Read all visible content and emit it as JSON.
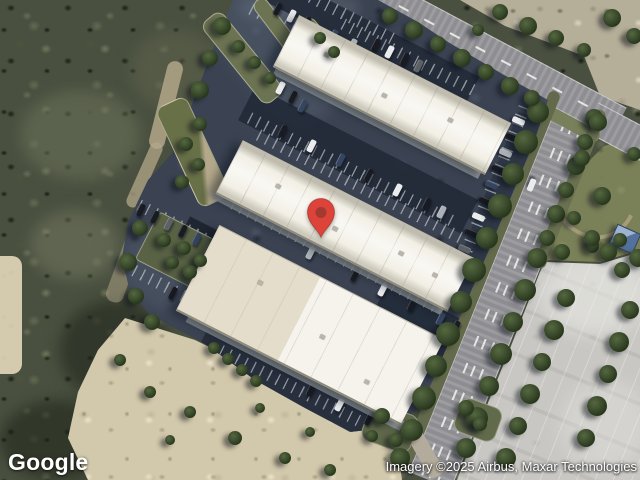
{
  "map": {
    "provider": "Google",
    "view_type": "satellite",
    "logo_text": "Google",
    "attribution_text": "Imagery ©2025 Airbus, Maxar Technologies",
    "marker": {
      "x": 321,
      "y": 239,
      "body_color": "#DD4339",
      "inner_dot_color": "#A23A30"
    }
  },
  "palette": {
    "woods": "#49503f",
    "sand": "#d2c8ab",
    "rock": "#b5ae98",
    "grass": "#7a8057",
    "asphalt": "#3b4352",
    "road": "#96969a",
    "concrete": "#c8c7c3",
    "roof_white": "#f2efe5",
    "roof_cream": "#e7e1d0",
    "hut_roof_blue": "#53719c"
  },
  "scene": {
    "car_colors": {
      "K": "#181b21",
      "W": "#e9ebec",
      "S": "#aab0b5",
      "B": "#35455f",
      "G": "#5c6165"
    },
    "stripes": [
      [
        340,
        12,
        120,
        27
      ],
      [
        300,
        34,
        110,
        27
      ],
      [
        410,
        58,
        150,
        27
      ],
      [
        352,
        170,
        230,
        27
      ],
      [
        361,
        187,
        230,
        27
      ],
      [
        340,
        258,
        240,
        27
      ],
      [
        310,
        396,
        200,
        27
      ],
      [
        172,
        222,
        110,
        27
      ],
      [
        192,
        300,
        130,
        27
      ],
      [
        487,
        200,
        200,
        112
      ]
    ],
    "cars": [
      [
        277,
        9,
        -63,
        "K"
      ],
      [
        291,
        16,
        -63,
        "W"
      ],
      [
        306,
        23,
        -63,
        "K"
      ],
      [
        333,
        36,
        -63,
        "B"
      ],
      [
        352,
        45,
        -63,
        "S"
      ],
      [
        375,
        45,
        -63,
        "K"
      ],
      [
        389,
        52,
        -63,
        "W"
      ],
      [
        404,
        59,
        -63,
        "K"
      ],
      [
        418,
        66,
        -63,
        "G"
      ],
      [
        280,
        88,
        -63,
        "W"
      ],
      [
        292,
        97,
        -63,
        "K"
      ],
      [
        302,
        106,
        -63,
        "B"
      ],
      [
        282,
        131,
        -63,
        "K"
      ],
      [
        311,
        146,
        -63,
        "W"
      ],
      [
        340,
        160,
        -63,
        "B"
      ],
      [
        368,
        175,
        -63,
        "K"
      ],
      [
        397,
        190,
        -63,
        "W"
      ],
      [
        426,
        204,
        -63,
        "K"
      ],
      [
        441,
        212,
        -63,
        "S"
      ],
      [
        310,
        253,
        -63,
        "S"
      ],
      [
        354,
        275,
        -63,
        "K"
      ],
      [
        382,
        290,
        -63,
        "W"
      ],
      [
        411,
        305,
        -63,
        "K"
      ],
      [
        440,
        319,
        -63,
        "B"
      ],
      [
        455,
        327,
        -63,
        "K"
      ],
      [
        310,
        390,
        -63,
        "K"
      ],
      [
        339,
        405,
        -63,
        "W"
      ],
      [
        368,
        419,
        -63,
        "K"
      ],
      [
        140,
        210,
        -63,
        "K"
      ],
      [
        154,
        217,
        -63,
        "K"
      ],
      [
        168,
        224,
        -63,
        "G"
      ],
      [
        182,
        231,
        -63,
        "K"
      ],
      [
        196,
        239,
        -63,
        "B"
      ],
      [
        172,
        293,
        -63,
        "K"
      ],
      [
        186,
        300,
        -63,
        "K"
      ],
      [
        214,
        314,
        -63,
        "W"
      ],
      [
        228,
        321,
        -63,
        "K"
      ],
      [
        219,
        241,
        27,
        "B"
      ],
      [
        226,
        255,
        27,
        "B"
      ],
      [
        232,
        269,
        27,
        "K"
      ],
      [
        518,
        121,
        23,
        "W"
      ],
      [
        512,
        137,
        23,
        "K"
      ],
      [
        505,
        153,
        23,
        "S"
      ],
      [
        498,
        169,
        23,
        "K"
      ],
      [
        491,
        185,
        23,
        "B"
      ],
      [
        485,
        201,
        23,
        "K"
      ],
      [
        478,
        217,
        23,
        "W"
      ],
      [
        471,
        233,
        23,
        "K"
      ],
      [
        464,
        249,
        23,
        "G"
      ],
      [
        458,
        265,
        23,
        "K"
      ],
      [
        245,
        262,
        27,
        "W",
        16
      ],
      [
        263,
        271,
        27,
        "W",
        16
      ],
      [
        531,
        185,
        112,
        "W"
      ]
    ],
    "trees": [
      [
        538,
        112,
        22
      ],
      [
        526,
        142,
        24
      ],
      [
        513,
        174,
        22
      ],
      [
        500,
        206,
        24
      ],
      [
        487,
        238,
        22
      ],
      [
        474,
        270,
        24
      ],
      [
        461,
        302,
        22
      ],
      [
        448,
        334,
        24
      ],
      [
        436,
        366,
        22
      ],
      [
        424,
        398,
        24
      ],
      [
        412,
        430,
        22
      ],
      [
        400,
        458,
        20
      ],
      [
        594,
        118,
        18
      ],
      [
        585,
        142,
        16
      ],
      [
        576,
        166,
        18
      ],
      [
        566,
        190,
        16
      ],
      [
        556,
        214,
        18
      ],
      [
        547,
        238,
        16
      ],
      [
        537,
        258,
        20
      ],
      [
        525,
        290,
        22
      ],
      [
        513,
        322,
        20
      ],
      [
        501,
        354,
        22
      ],
      [
        489,
        386,
        20
      ],
      [
        477,
        418,
        22
      ],
      [
        466,
        448,
        20
      ],
      [
        566,
        298,
        18
      ],
      [
        554,
        330,
        20
      ],
      [
        542,
        362,
        18
      ],
      [
        530,
        394,
        20
      ],
      [
        518,
        426,
        18
      ],
      [
        506,
        458,
        20
      ],
      [
        630,
        310,
        18
      ],
      [
        619,
        342,
        20
      ],
      [
        608,
        374,
        18
      ],
      [
        597,
        406,
        20
      ],
      [
        586,
        438,
        18
      ],
      [
        562,
        252,
        16
      ],
      [
        592,
        246,
        14
      ],
      [
        620,
        240,
        14
      ],
      [
        598,
        122,
        18
      ],
      [
        582,
        158,
        16
      ],
      [
        602,
        196,
        18
      ],
      [
        574,
        218,
        14
      ],
      [
        592,
        238,
        16
      ],
      [
        634,
        154,
        14
      ],
      [
        608,
        252,
        18
      ],
      [
        638,
        258,
        18
      ],
      [
        622,
        270,
        16
      ],
      [
        500,
        12,
        16
      ],
      [
        528,
        26,
        18
      ],
      [
        556,
        38,
        16
      ],
      [
        584,
        50,
        14
      ],
      [
        612,
        18,
        18
      ],
      [
        634,
        36,
        16
      ],
      [
        478,
        30,
        12
      ],
      [
        390,
        16,
        16
      ],
      [
        414,
        30,
        18
      ],
      [
        438,
        44,
        16
      ],
      [
        462,
        58,
        18
      ],
      [
        486,
        72,
        16
      ],
      [
        510,
        86,
        18
      ],
      [
        532,
        98,
        16
      ],
      [
        222,
        26,
        18
      ],
      [
        210,
        58,
        16
      ],
      [
        200,
        90,
        18
      ],
      [
        238,
        46,
        13
      ],
      [
        254,
        62,
        13
      ],
      [
        270,
        78,
        12
      ],
      [
        320,
        38,
        12
      ],
      [
        334,
        52,
        12
      ],
      [
        200,
        124,
        14
      ],
      [
        186,
        144,
        14
      ],
      [
        198,
        164,
        13
      ],
      [
        182,
        182,
        14
      ],
      [
        164,
        240,
        14
      ],
      [
        184,
        248,
        14
      ],
      [
        200,
        260,
        13
      ],
      [
        172,
        262,
        13
      ],
      [
        190,
        272,
        14
      ],
      [
        140,
        228,
        16
      ],
      [
        128,
        262,
        18
      ],
      [
        136,
        296,
        16
      ],
      [
        152,
        322,
        16
      ],
      [
        214,
        348,
        12
      ],
      [
        228,
        359,
        12
      ],
      [
        242,
        370,
        12
      ],
      [
        256,
        381,
        12
      ],
      [
        382,
        416,
        16
      ],
      [
        396,
        440,
        14
      ],
      [
        372,
        436,
        12
      ],
      [
        466,
        408,
        16
      ],
      [
        480,
        424,
        14
      ],
      [
        150,
        392,
        12
      ],
      [
        190,
        412,
        12
      ],
      [
        235,
        438,
        14
      ],
      [
        285,
        458,
        12
      ],
      [
        330,
        470,
        12
      ],
      [
        120,
        360,
        12
      ],
      [
        170,
        440,
        10
      ],
      [
        260,
        408,
        10
      ],
      [
        310,
        432,
        10
      ]
    ]
  }
}
